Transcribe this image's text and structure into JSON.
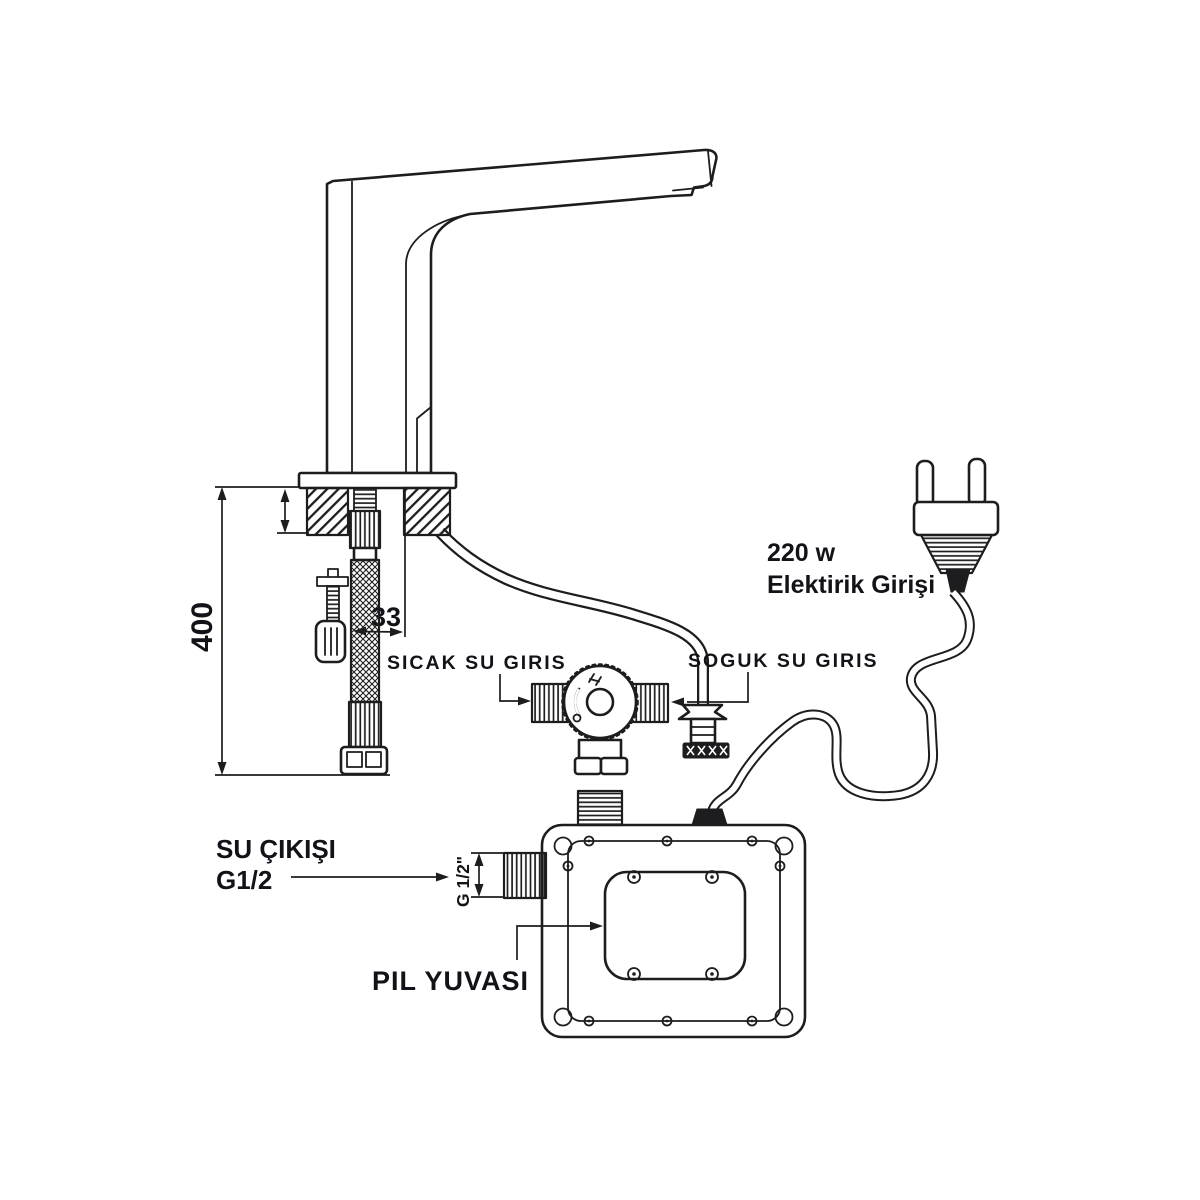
{
  "diagram": {
    "labels": {
      "hot_water_inlet": "SICAK SU GIRIS",
      "cold_water_inlet": "SOGUK SU GIRIS",
      "power_line1": "220 w",
      "power_line2": "Elektirik Girişi",
      "water_outlet_line1": "SU ÇIKIŞI",
      "water_outlet_line2": "G1/2",
      "battery_compartment": "PIL YUVASI"
    },
    "dimensions": {
      "faucet_hose_length": "400",
      "hose_offset": "33",
      "outlet_thread_size": "G 1/2\""
    },
    "colors": {
      "line": "#1d1d1f",
      "text": "#121218",
      "background": "#ffffff"
    }
  }
}
